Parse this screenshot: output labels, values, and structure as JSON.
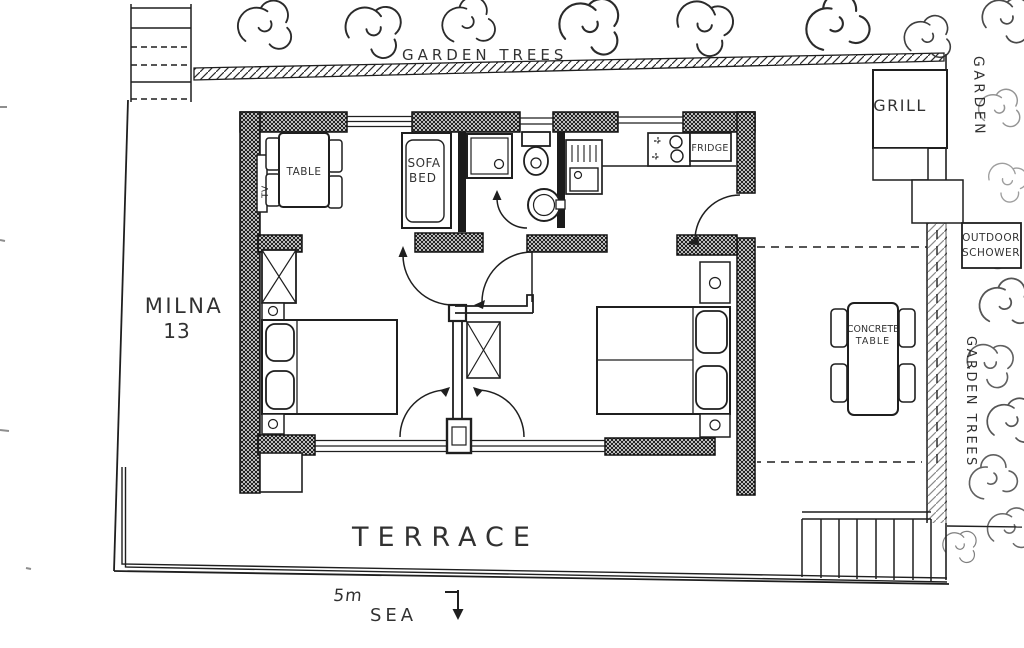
{
  "colors": {
    "ink": "#1f1f1f",
    "paper": "#ffffff"
  },
  "plan": {
    "site": {
      "garden_trees_top_label": "GARDEN TREES",
      "garden_right_label": "GARDEN",
      "garden_trees_right_label": "GARDEN TREES",
      "grill_label": "GRILL",
      "outdoor_shower_line1": "OUTDOOR",
      "outdoor_shower_line2": "SCHOWER",
      "concrete_table_line1": "CONCRETE",
      "concrete_table_line2": "TABLE",
      "terrace_label": "TERRACE",
      "scale_label": "5m",
      "sea_label": "SEA"
    },
    "house": {
      "name_line1": "MILNA",
      "name_line2": "13",
      "living": {
        "table_label": "TABLE",
        "tv_label": "TV",
        "sofa_line1": "SOFA",
        "sofa_line2": "BED"
      },
      "kitchen": {
        "fridge_label": "FRIDGE"
      }
    }
  }
}
